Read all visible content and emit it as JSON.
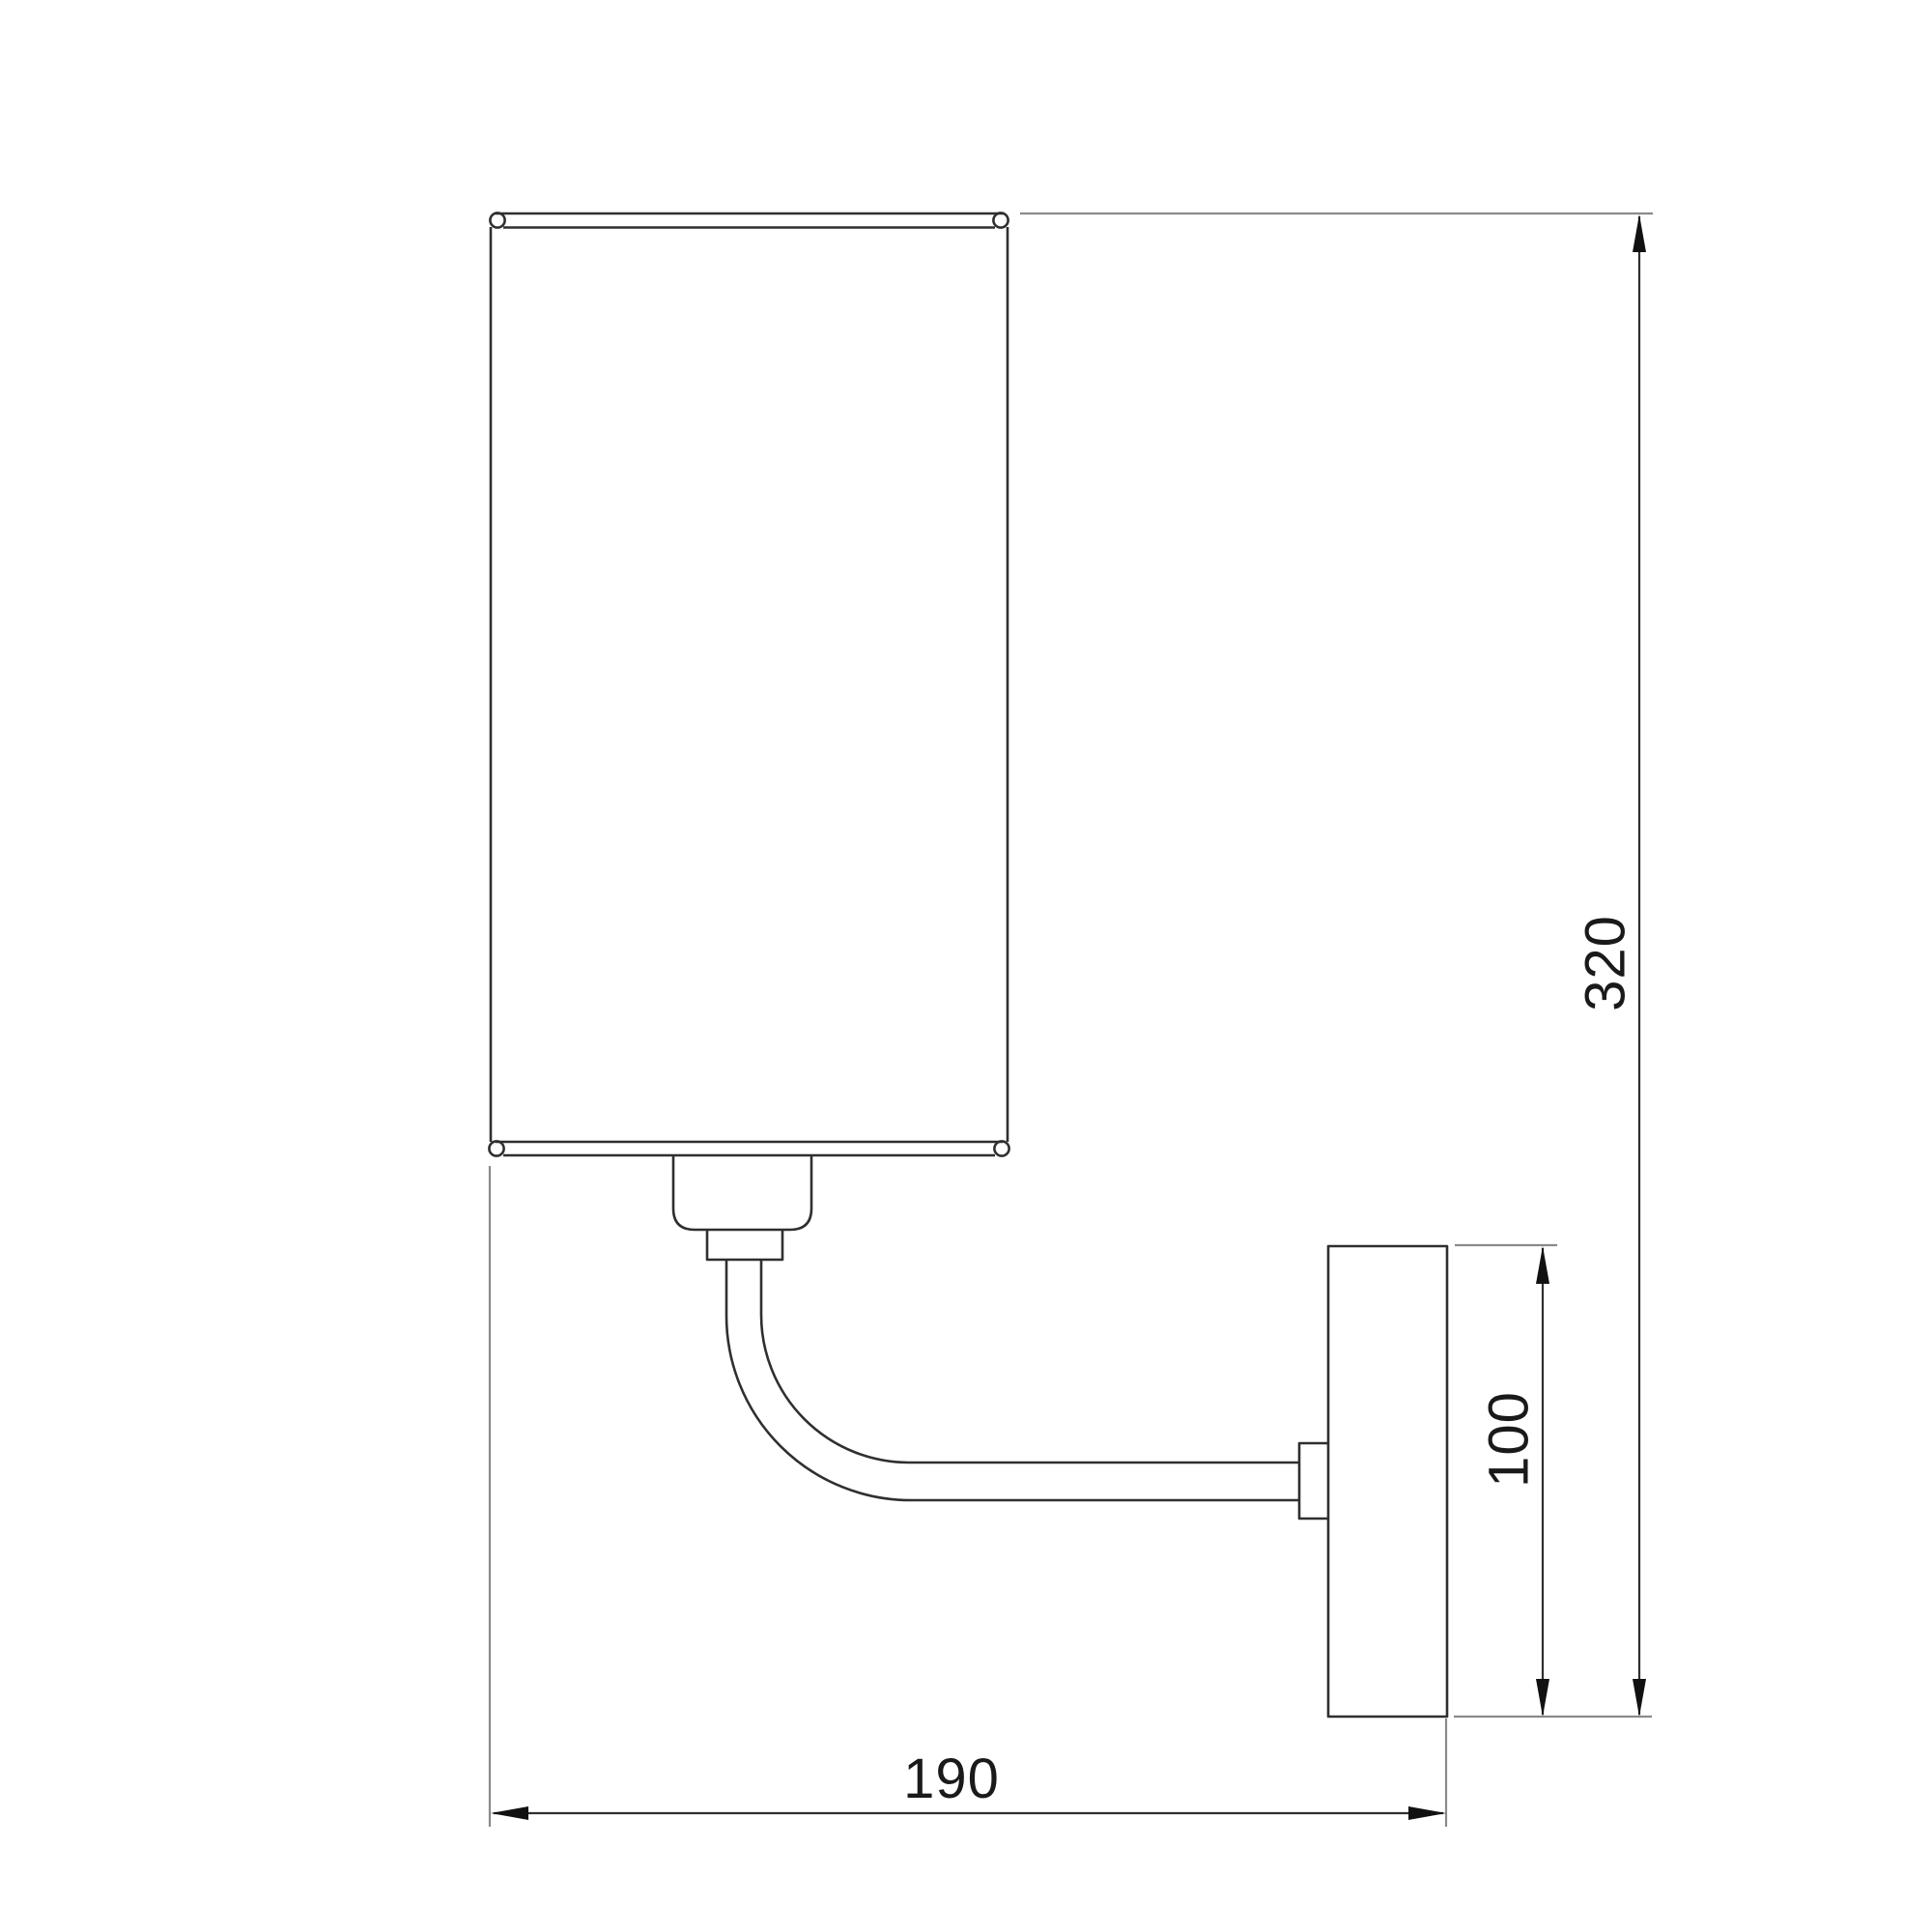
{
  "drawing": {
    "kind": "wall-sconce-dimension-drawing",
    "background_color": "#ffffff",
    "object_line_color": "#2f2f2f",
    "extension_line_color": "#8a8a8a",
    "text_color": "#1a1a1a",
    "dimensions": {
      "overall_height": {
        "value": "320",
        "orientation": "vertical"
      },
      "backplate_height": {
        "value": "100",
        "orientation": "vertical"
      },
      "projection_depth": {
        "value": "190",
        "orientation": "horizontal"
      }
    }
  }
}
